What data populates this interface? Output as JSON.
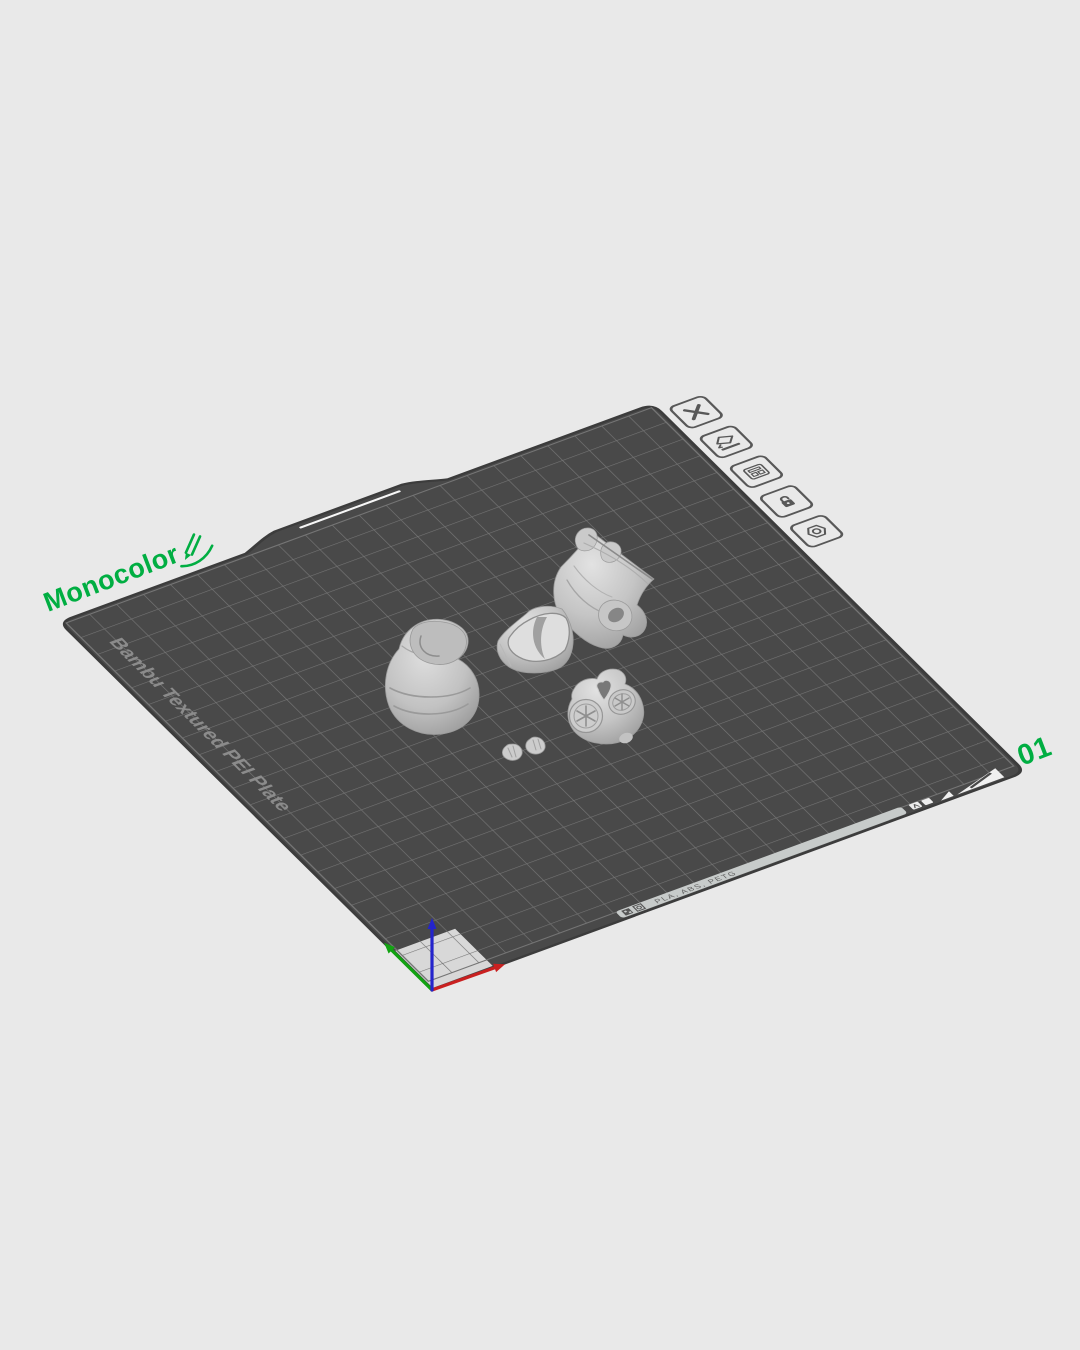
{
  "plate": {
    "name_label": "Monocolor",
    "number_label": "01",
    "surface_text": "Bambu Textured PEI Plate",
    "strip_text": "PLA, ABS, PETG",
    "grid_cells": 22
  },
  "toolbar": {
    "items": [
      {
        "id": "delete-plate",
        "icon": "close-icon"
      },
      {
        "id": "rename-plate",
        "icon": "edit-icon"
      },
      {
        "id": "plate-settings",
        "icon": "layout-icon"
      },
      {
        "id": "lock-plate",
        "icon": "unlock-icon"
      },
      {
        "id": "plate-config",
        "icon": "nut-icon"
      }
    ]
  },
  "models": [
    {
      "id": "turban-swirl-part"
    },
    {
      "id": "vest-body-part"
    },
    {
      "id": "head-part"
    },
    {
      "id": "mask-pod-part"
    },
    {
      "id": "hand-part-left"
    },
    {
      "id": "hand-part-right"
    }
  ],
  "axes": {
    "x_color": "#c92020",
    "y_color": "#12a312",
    "z_color": "#2424cc"
  },
  "colors": {
    "background": "#e9e9e9",
    "plate_surface": "#494949",
    "grid_line": "#757575",
    "plate_outline": "#3c3c3c",
    "accent_green": "#00AE42",
    "model_gray": "#c6c6c6",
    "highlight_cells": "#d8d8d8",
    "strip": "#c7cbca"
  }
}
